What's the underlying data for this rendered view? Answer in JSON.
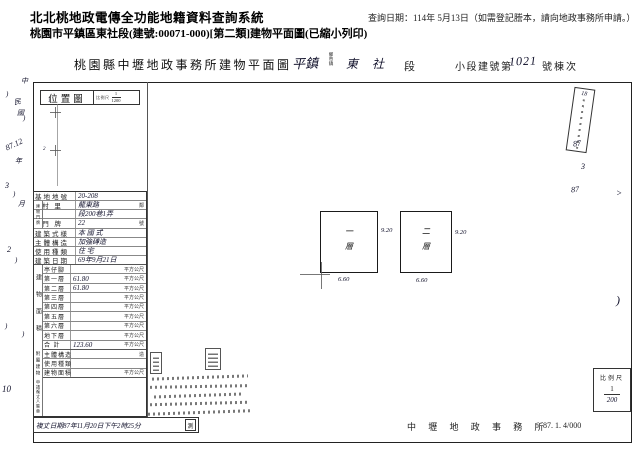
{
  "app": {
    "system_title": "北北桃地政電傳全功能地籍資料查詢系統",
    "query_date": "查詢日期：114年 5月13日（如需登記謄本，請向地政事務所申請。）",
    "subtitle": "桃園市平鎮區東社段(建號:00071-000)[第二類]建物平面圖(已縮小列印)"
  },
  "doc": {
    "title": "桃園縣中壢地政事務所建物平面圖",
    "township": "平鎮",
    "township_units": "鄉市鎮",
    "section": "東社",
    "section_suffix": "段",
    "lot_prefix": "小段建號第",
    "lot_number": "1021",
    "lot_suffix": "號棟次",
    "location_map": {
      "label": "位置圖",
      "scale_label": "比例尺",
      "scale_num": "1",
      "scale_den": "1200"
    },
    "door_group": "建物門牌",
    "main_rows": [
      {
        "l": "基地地號",
        "v": "20-208",
        "u": ""
      },
      {
        "l": "  村 里",
        "v": "龍東路",
        "u": "鄰"
      },
      {
        "l": "",
        "v": "段200巷1弄",
        "u": ""
      },
      {
        "l": "  門 牌",
        "v": "22",
        "u": "號"
      },
      {
        "l": "建築式樣",
        "v": "本 國 式",
        "u": ""
      },
      {
        "l": "主體構造",
        "v": "加強磚造",
        "u": ""
      },
      {
        "l": "使用種類",
        "v": "住 宅",
        "u": ""
      },
      {
        "l": "建築日期",
        "v": "69年9月21日",
        "u": ""
      }
    ],
    "area_group": "建物面積",
    "area_rows": [
      {
        "l": "亭仔腳",
        "v": "",
        "u": "平方公尺"
      },
      {
        "l": "第一層",
        "v": "61.80",
        "u": "平方公尺"
      },
      {
        "l": "第二層",
        "v": "61.80",
        "u": "平方公尺"
      },
      {
        "l": "第三層",
        "v": "",
        "u": "平方公尺"
      },
      {
        "l": "第四層",
        "v": "",
        "u": "平方公尺"
      },
      {
        "l": "第五層",
        "v": "",
        "u": "平方公尺"
      },
      {
        "l": "第六層",
        "v": "",
        "u": "平方公尺"
      },
      {
        "l": "地下層",
        "v": "",
        "u": "平方公尺"
      },
      {
        "l": "合 計",
        "v": "123.60",
        "u": "平方公尺"
      }
    ],
    "annex_group": "附屬建物",
    "annex_rows": [
      {
        "l": "主體構造",
        "v": "",
        "u": "造"
      },
      {
        "l": "使用種類",
        "v": "",
        "u": ""
      },
      {
        "l": "建物面積",
        "v": "",
        "u": "平方公尺"
      }
    ],
    "applicant_label": "申請複丈人簽章",
    "floors": [
      {
        "name": "一層",
        "depth": "9.20",
        "width": "6.60"
      },
      {
        "name": "二層",
        "depth": "9.20",
        "width": "6.60"
      }
    ],
    "survey_line": "複丈日期87年11月20日下午2時25分",
    "survey_seal": "測",
    "office": "中 壢 地 政 事 務 所",
    "form_code": "87. 1. 4/000",
    "scale_box": {
      "label": "比例尺",
      "num": "1",
      "den": "200"
    },
    "slant_note": "18",
    "left_marks": [
      {
        "t": "中",
        "x": 21,
        "y": 76
      },
      {
        "t": ")",
        "x": 6,
        "y": 90
      },
      {
        "t": "民",
        "x": 14,
        "y": 97,
        "r": -10
      },
      {
        "t": "國",
        "x": 17,
        "y": 108
      },
      {
        "t": ")",
        "x": 23,
        "y": 114
      },
      {
        "t": "87.12",
        "x": 5,
        "y": 140,
        "r": -25,
        "s": 8
      },
      {
        "t": "年",
        "x": 15,
        "y": 156
      },
      {
        "t": "3",
        "x": 5,
        "y": 181,
        "s": 8
      },
      {
        "t": ")",
        "x": 13,
        "y": 190
      },
      {
        "t": "月",
        "x": 18,
        "y": 199
      },
      {
        "t": "2",
        "x": 7,
        "y": 245,
        "s": 8
      },
      {
        "t": ")",
        "x": 15,
        "y": 256
      },
      {
        "t": ")",
        "x": 5,
        "y": 322
      },
      {
        "t": ")",
        "x": 22,
        "y": 330
      },
      {
        "t": "10",
        "x": 2,
        "y": 384,
        "s": 9
      }
    ],
    "right_marks": [
      {
        "t": "87",
        "x": 573,
        "y": 139,
        "s": 8,
        "r": -8
      },
      {
        "t": "3",
        "x": 581,
        "y": 162,
        "s": 8
      },
      {
        "t": "87",
        "x": 571,
        "y": 185,
        "s": 8,
        "r": -5
      },
      {
        "t": ">",
        "x": 616,
        "y": 188,
        "s": 9
      },
      {
        "t": ")",
        "x": 616,
        "y": 293,
        "s": 12
      }
    ],
    "map_marks": [
      {
        "t": "1",
        "x": 48,
        "y": 99,
        "s": 5
      },
      {
        "t": "2",
        "x": 43,
        "y": 147,
        "s": 5
      }
    ]
  }
}
